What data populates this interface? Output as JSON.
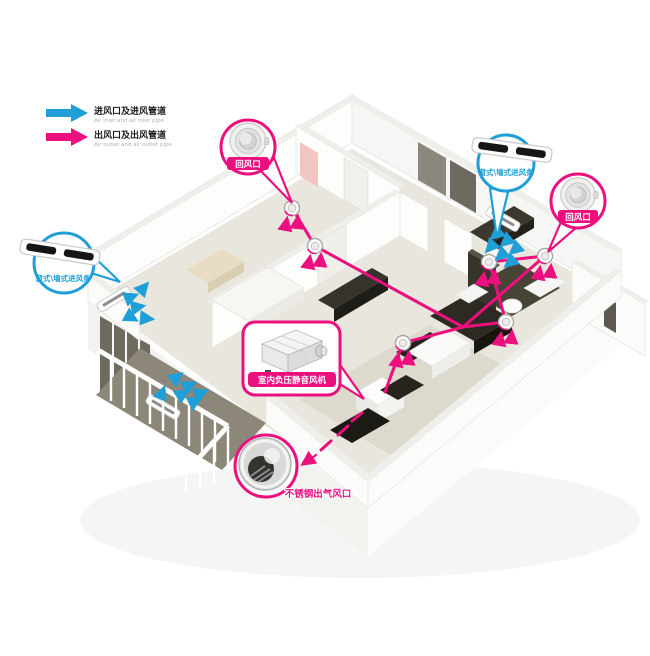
{
  "legend": {
    "items": [
      {
        "zh": "进风口及进风管道",
        "en": "Air inlet and air inlet pipe",
        "color": "#1f9fd8"
      },
      {
        "zh": "出风口及出风管道",
        "en": "Air outlet and air outlet pipe",
        "color": "#ec0f7e"
      }
    ]
  },
  "callouts": {
    "return_air_top": "回风口",
    "return_air_right": "回风口",
    "window_wall_inlet_left": "窗式\\墙式进风条",
    "window_wall_inlet_right": "窗式\\墙式进风条",
    "indoor_fan": "室内负压静音风机",
    "stainless_outlet": "不锈钢出气风口"
  },
  "colors": {
    "inlet_blue": "#1f9fd8",
    "outlet_magenta": "#ec0f7e",
    "floor_beige": "#e9e6de",
    "wall_white": "#fdfdfc",
    "furniture_dark": "#2c2a23"
  }
}
